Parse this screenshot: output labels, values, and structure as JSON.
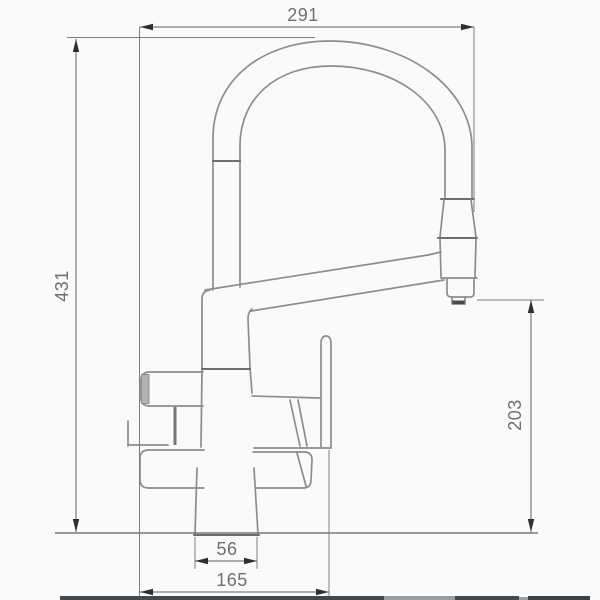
{
  "drawing": {
    "kind": "faucet-dimension-drawing",
    "dimensions": {
      "top_width": "291",
      "overall_height": "431",
      "outlet_height": "203",
      "base_width": "56",
      "handle_span": "165"
    },
    "colors": {
      "background": "#fafafa",
      "object_line": "#8d8d8d",
      "dimension_line": "#5f5f5f",
      "arrow": "#2e2e2e",
      "label_text": "#6f6f6f",
      "handle_cap_fill": "#b2b2b2",
      "bottom_band_dark": "#45484b",
      "bottom_band_light": "#989da0"
    }
  }
}
